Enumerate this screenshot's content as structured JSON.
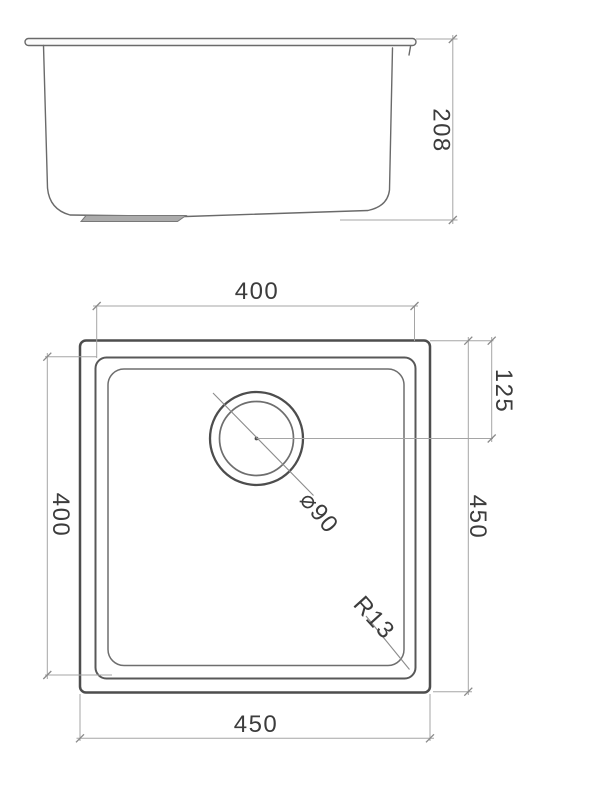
{
  "title": "sink-technical-drawing",
  "colors": {
    "background": "#ffffff",
    "line_heavy": "#4d4d4d",
    "line_mid": "#585858",
    "line_thin": "#6e6e6e",
    "line_profile": "#6a6a6a",
    "dim_line": "#a5a5a5",
    "tick": "#8a8a8a",
    "leader": "#8c8c8c",
    "text": "#3c3c3c",
    "boss_fill": "#ababab",
    "boss_stroke": "#787878"
  },
  "dimensions": {
    "side_height": "208",
    "bowl_width": "400",
    "bowl_depth": "400",
    "overall_width": "450",
    "overall_depth": "450",
    "drain_offset": "125",
    "drain_diameter": "⌀90",
    "corner_radius": "R13"
  }
}
